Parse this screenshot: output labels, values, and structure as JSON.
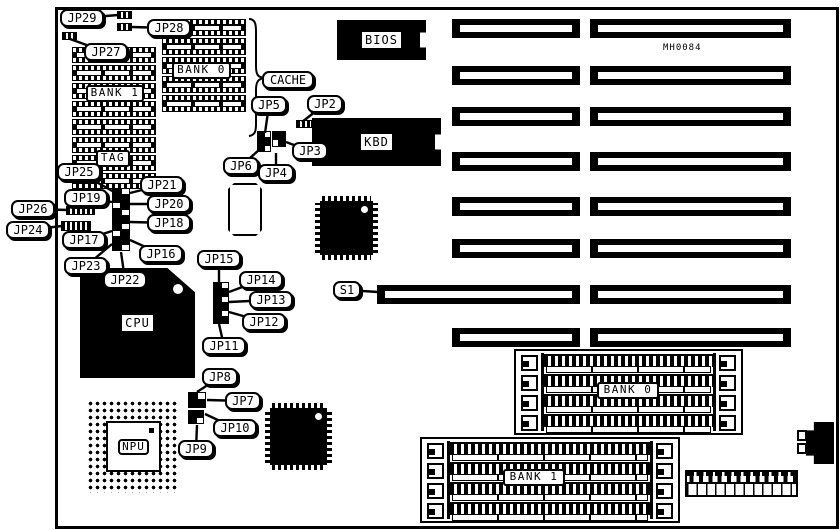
{
  "diagram": {
    "components": {
      "bios": "BIOS",
      "kbd": "KBD",
      "cpu": "CPU",
      "npu": "NPU",
      "board_id": "MH0084"
    },
    "callouts": [
      {
        "label": "JP29",
        "x": 60,
        "y": 9,
        "tx": 118,
        "ty": 15
      },
      {
        "label": "JP28",
        "x": 147,
        "y": 19,
        "tx": 131,
        "ty": 27
      },
      {
        "label": "JP27",
        "x": 84,
        "y": 43,
        "tx": 70,
        "ty": 39
      },
      {
        "label": "CACHE",
        "x": 262,
        "y": 71
      },
      {
        "label": "JP5",
        "x": 251,
        "y": 96,
        "tx": 265,
        "ty": 133
      },
      {
        "label": "JP2",
        "x": 307,
        "y": 95,
        "tx": 302,
        "ty": 122
      },
      {
        "label": "JP3",
        "x": 292,
        "y": 142,
        "tx": 286,
        "ty": 142
      },
      {
        "label": "JP6",
        "x": 223,
        "y": 157,
        "tx": 260,
        "ty": 149
      },
      {
        "label": "JP4",
        "x": 258,
        "y": 164,
        "tx": 276,
        "ty": 153
      },
      {
        "label": "JP25",
        "x": 57,
        "y": 163,
        "tx": 114,
        "ty": 192
      },
      {
        "label": "JP21",
        "x": 140,
        "y": 176,
        "tx": 130,
        "ty": 193
      },
      {
        "label": "JP19",
        "x": 64,
        "y": 189,
        "tx": 112,
        "ty": 202
      },
      {
        "label": "JP20",
        "x": 147,
        "y": 195,
        "tx": 130,
        "ty": 204
      },
      {
        "label": "JP26",
        "x": 11,
        "y": 200,
        "tx": 67,
        "ty": 210
      },
      {
        "label": "JP18",
        "x": 147,
        "y": 214,
        "tx": 130,
        "ty": 222
      },
      {
        "label": "JP24",
        "x": 6,
        "y": 221,
        "tx": 62,
        "ty": 226
      },
      {
        "label": "JP17",
        "x": 62,
        "y": 231,
        "tx": 112,
        "ty": 231
      },
      {
        "label": "JP16",
        "x": 139,
        "y": 245,
        "tx": 130,
        "ty": 240
      },
      {
        "label": "JP23",
        "x": 64,
        "y": 257,
        "tx": 112,
        "ty": 244
      },
      {
        "label": "JP22",
        "x": 103,
        "y": 271,
        "tx": 121,
        "ty": 252
      },
      {
        "label": "JP15",
        "x": 197,
        "y": 250,
        "tx": 219,
        "ty": 283
      },
      {
        "label": "JP14",
        "x": 239,
        "y": 271,
        "tx": 229,
        "ty": 292
      },
      {
        "label": "JP13",
        "x": 249,
        "y": 291,
        "tx": 229,
        "ty": 302
      },
      {
        "label": "JP12",
        "x": 242,
        "y": 313,
        "tx": 229,
        "ty": 312
      },
      {
        "label": "JP11",
        "x": 202,
        "y": 337,
        "tx": 219,
        "ty": 324
      },
      {
        "label": "JP8",
        "x": 202,
        "y": 368,
        "tx": 197,
        "ty": 392
      },
      {
        "label": "JP7",
        "x": 225,
        "y": 392,
        "tx": 207,
        "ty": 400
      },
      {
        "label": "JP10",
        "x": 213,
        "y": 419,
        "tx": 205,
        "ty": 414
      },
      {
        "label": "JP9",
        "x": 178,
        "y": 440,
        "tx": 197,
        "ty": 425
      },
      {
        "label": "S1",
        "x": 333,
        "y": 281,
        "tx": 378,
        "ty": 292
      }
    ],
    "slots": {
      "x_short": 452,
      "w_short": 128,
      "x_long": 590,
      "w_long": 201,
      "h": 19,
      "rows_y": [
        19,
        66,
        107,
        152,
        197,
        239,
        285,
        328
      ],
      "s1_row": 6,
      "s1_x": 377,
      "s1_w": 203
    },
    "cache_chip_columns": [
      {
        "x": 72,
        "y": 47,
        "w": 84,
        "count": 8,
        "pitch": 18,
        "h": 16
      },
      {
        "x": 162,
        "y": 19,
        "w": 84,
        "count": 5,
        "pitch": 19,
        "h": 17
      }
    ],
    "label_boxes": [
      {
        "key": "cache-bank1",
        "label": "BANK 1",
        "x": 86,
        "y": 85,
        "w": 58
      },
      {
        "key": "cache-bank0",
        "label": "BANK 0",
        "x": 172,
        "y": 62,
        "w": 59
      },
      {
        "key": "tag",
        "label": "TAG",
        "x": 96,
        "y": 150,
        "w": 34
      }
    ],
    "simm_banks": [
      {
        "key": "simm-bank0",
        "label": "BANK 0",
        "x": 514,
        "y": 349,
        "w": 229,
        "h": 86,
        "lx": 597,
        "ly": 382,
        "lw": 62
      },
      {
        "key": "simm-bank1",
        "label": "BANK 1",
        "x": 420,
        "y": 437,
        "w": 260,
        "h": 86,
        "lx": 503,
        "ly": 469,
        "lw": 62
      }
    ],
    "jumpers_small": [
      {
        "key": "jp29-jumper",
        "x": 117,
        "y": 11,
        "w": 15,
        "h": 8
      },
      {
        "key": "jp28-jumper",
        "x": 117,
        "y": 23,
        "w": 15,
        "h": 8
      },
      {
        "key": "jp27-jumper",
        "x": 62,
        "y": 32,
        "w": 15,
        "h": 8
      },
      {
        "key": "jp2-jumper",
        "x": 296,
        "y": 120,
        "w": 16,
        "h": 8
      },
      {
        "key": "jp26-jumper",
        "x": 66,
        "y": 206,
        "w": 29,
        "h": 9
      },
      {
        "key": "jp24-jumper",
        "x": 61,
        "y": 221,
        "w": 30,
        "h": 10
      }
    ],
    "jumper_grids": [
      {
        "key": "jp5-block-a",
        "x": 257,
        "y": 131,
        "cols": 2,
        "rows": 3,
        "cw": 7,
        "ch": 7,
        "fill": [
          1,
          0,
          1,
          1,
          1,
          0
        ]
      },
      {
        "key": "jp5-block-b",
        "x": 272,
        "y": 131,
        "cols": 2,
        "rows": 2,
        "cw": 7,
        "ch": 8,
        "fill": [
          1,
          1,
          0,
          1
        ]
      },
      {
        "key": "center-jumper-block",
        "x": 112,
        "y": 188,
        "cols": 2,
        "rows": 9,
        "cw": 9,
        "ch": 7,
        "fill": [
          1,
          0,
          1,
          1,
          0,
          1,
          1,
          0,
          1,
          1,
          1,
          0,
          0,
          1,
          1,
          1,
          1,
          0
        ]
      },
      {
        "key": "jp11-15-block",
        "x": 213,
        "y": 282,
        "cols": 2,
        "rows": 6,
        "cw": 8,
        "ch": 7,
        "fill": [
          1,
          0,
          1,
          1,
          1,
          0,
          1,
          1,
          1,
          0,
          1,
          1
        ]
      },
      {
        "key": "jp7-8-block",
        "x": 188,
        "y": 392,
        "cols": 2,
        "rows": 2,
        "cw": 9,
        "ch": 8,
        "fill": [
          1,
          0,
          1,
          1
        ]
      },
      {
        "key": "jp9-10-block",
        "x": 188,
        "y": 410,
        "cols": 2,
        "rows": 2,
        "cw": 8,
        "ch": 7,
        "fill": [
          1,
          1,
          1,
          0
        ]
      }
    ]
  }
}
